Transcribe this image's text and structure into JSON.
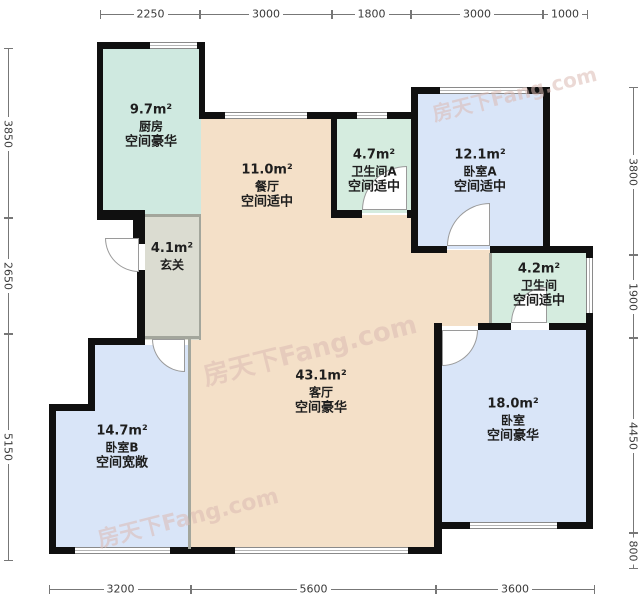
{
  "watermark": "房天下Fang.com",
  "rooms": {
    "kitchen": {
      "area": "9.7m²",
      "name": "厨房",
      "tag": "空间豪华"
    },
    "dining": {
      "area": "11.0m²",
      "name": "餐厅",
      "tag": "空间适中"
    },
    "bath_a": {
      "area": "4.7m²",
      "name": "卫生间A",
      "tag": "空间适中"
    },
    "bedroom_a": {
      "area": "12.1m²",
      "name": "卧室A",
      "tag": "空间适中"
    },
    "hallway": {
      "area": "4.1m²",
      "name": "玄关",
      "tag": ""
    },
    "bath": {
      "area": "4.2m²",
      "name": "卫生间",
      "tag": "空间适中"
    },
    "living": {
      "area": "43.1m²",
      "name": "客厅",
      "tag": "空间豪华"
    },
    "bedroom_b": {
      "area": "14.7m²",
      "name": "卧室B",
      "tag": "空间宽敞"
    },
    "bedroom": {
      "area": "18.0m²",
      "name": "卧室",
      "tag": "空间豪华"
    }
  },
  "dimensions": {
    "top": [
      {
        "label": "2250"
      },
      {
        "label": "3000"
      },
      {
        "label": "1800"
      },
      {
        "label": "3000"
      },
      {
        "label": "1000"
      }
    ],
    "bottom": [
      {
        "label": "3200"
      },
      {
        "label": "5600"
      },
      {
        "label": "3600"
      }
    ],
    "left": [
      {
        "label": "3850"
      },
      {
        "label": "2650"
      },
      {
        "label": "5150"
      }
    ],
    "right": [
      {
        "label": "3800"
      },
      {
        "label": "1900"
      },
      {
        "label": "4450"
      },
      {
        "label": "800"
      }
    ]
  },
  "colors": {
    "wall": "#101010",
    "kitchen_bath_fill": "#d5ecdf",
    "kitchen_fill": "#cfe9e0",
    "living_fill": "#f4e0c8",
    "bedroom_fill": "#d9e5f8",
    "hallway_fill": "#dbdcd1",
    "dimension_line": "#777777",
    "watermark_color": "#dbbab2"
  }
}
